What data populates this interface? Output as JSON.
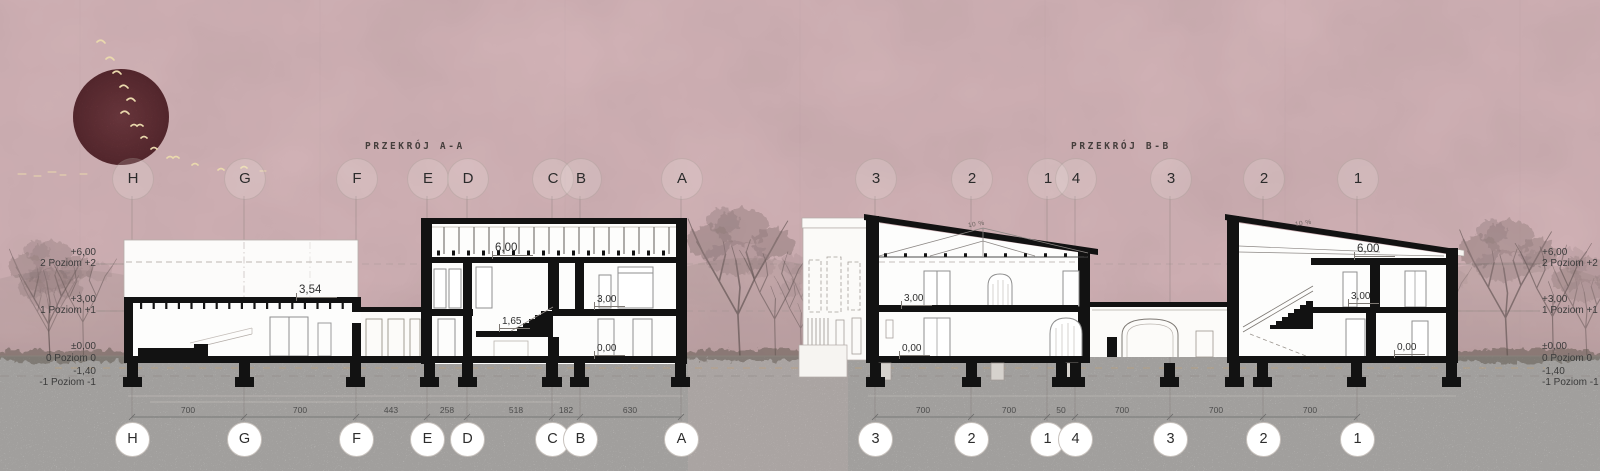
{
  "drawing": {
    "section_a": {
      "title": "PRZEKRÓJ A-A",
      "grid_letters": [
        "H",
        "G",
        "F",
        "E",
        "D",
        "C",
        "B",
        "A"
      ],
      "dimensions": [
        "700",
        "700",
        "443",
        "258",
        "518",
        "182",
        "630"
      ],
      "levels": {
        "roof_low": "3,54",
        "clerestory": "6,00",
        "landing": "1,65",
        "floor_1": "3,00",
        "floor_0": "0,00"
      }
    },
    "section_b": {
      "title": "PRZEKRÓJ B-B",
      "grid_numbers": [
        "3",
        "2",
        "1",
        "4",
        "3",
        "2",
        "1"
      ],
      "dimensions": [
        "700",
        "700",
        "50",
        "700",
        "700",
        "700"
      ],
      "roof_slope": "10 %",
      "building_1": {
        "floor_1": "3,00",
        "floor_0": "0,00"
      },
      "building_2": {
        "roof": "6,00",
        "floor_1": "3,00",
        "floor_0": "0,00"
      }
    },
    "elevation_levels": [
      {
        "value": "+6,00",
        "label": "2 Poziom +2"
      },
      {
        "value": "+3,00",
        "label": "1 Poziom +1"
      },
      {
        "value": "±0,00",
        "label": "0 Poziom 0"
      },
      {
        "value": "-1,40",
        "label": "-1 Poziom -1"
      }
    ],
    "colors": {
      "background": "#d7b7bb",
      "sun": "#7b3c44",
      "ground": "#e8e6e3",
      "ink": "#121212",
      "birds": "#ead9ad"
    }
  }
}
